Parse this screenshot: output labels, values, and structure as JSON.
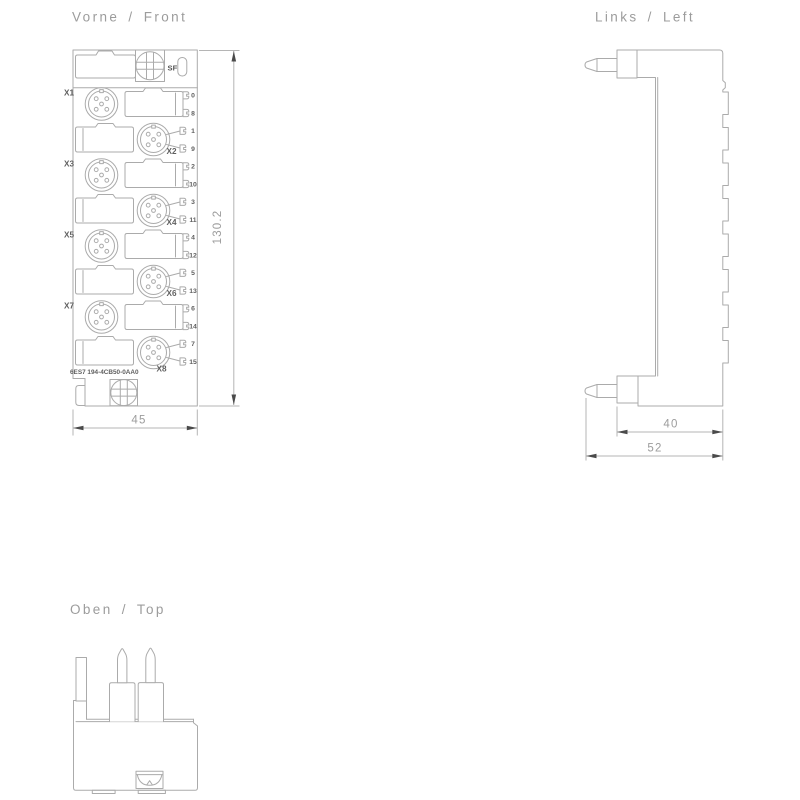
{
  "views": {
    "front": {
      "title": "Vorne / Front",
      "sf_label": "SF",
      "part_number": "6ES7 194-4CB50-0AA0",
      "rows": [
        {
          "label": "X1",
          "top": "0",
          "bottom": "8"
        },
        {
          "label": "X2",
          "top": "1",
          "bottom": "9"
        },
        {
          "label": "X3",
          "top": "2",
          "bottom": "10"
        },
        {
          "label": "X4",
          "top": "3",
          "bottom": "11"
        },
        {
          "label": "X5",
          "top": "4",
          "bottom": "12"
        },
        {
          "label": "X6",
          "top": "5",
          "bottom": "13"
        },
        {
          "label": "X7",
          "top": "6",
          "bottom": "14"
        },
        {
          "label": "X8",
          "top": "7",
          "bottom": "15"
        }
      ],
      "dim_height": "130.2",
      "dim_width": "45"
    },
    "left": {
      "title": "Links / Left",
      "dim_inner": "40",
      "dim_outer": "52"
    },
    "top": {
      "title": "Oben / Top"
    }
  },
  "colors": {
    "background": "#ffffff",
    "outline": "#ababab",
    "dimension_line": "#b5b5b5",
    "arrow": "#4a4a4a",
    "text_light": "#9c9c9c",
    "text_dark": "#5f5f5f"
  }
}
